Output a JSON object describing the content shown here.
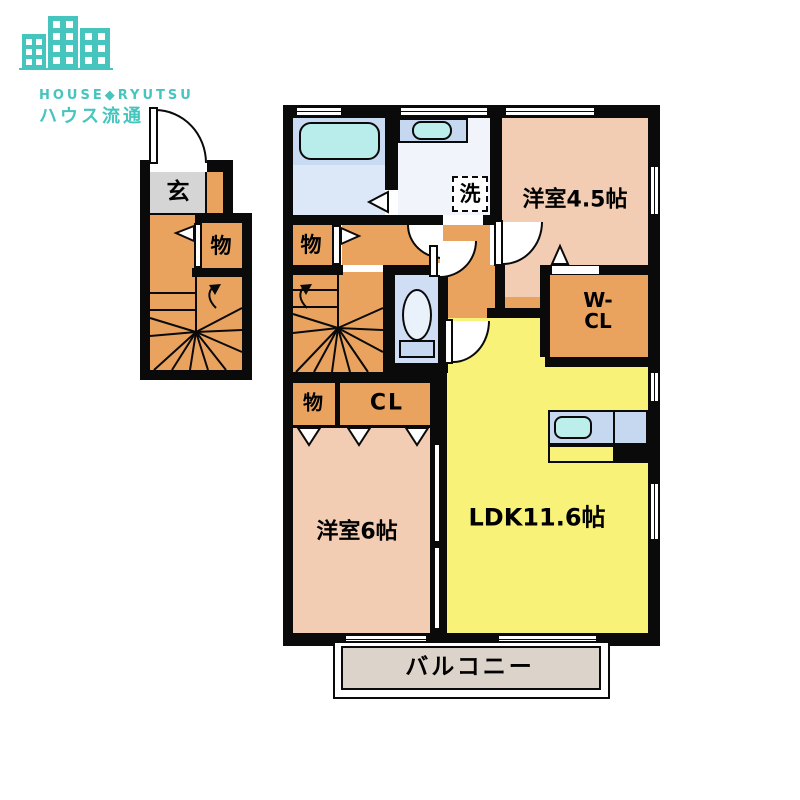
{
  "logo": {
    "brand_en": "HOUSE◆RYUTSU",
    "brand_jp": "ハウス流通",
    "color": "#45c5bd"
  },
  "first_floor": {
    "entrance": "玄",
    "storage": "物"
  },
  "second_floor": {
    "hall_storage": "物",
    "laundry": "洗",
    "bedroom1": "洋室4.5帖",
    "wic_line1": "W-",
    "wic_line2": "CL",
    "closet_storage": "物",
    "closet": "CL",
    "bedroom2": "洋室6帖",
    "ldk": "LDK11.6帖",
    "balcony": "バルコニー"
  },
  "colors": {
    "wall": "#0a0a0a",
    "wood_orange": "#e9a35f",
    "room_pink": "#f2cdb4",
    "ldk_yellow": "#f8f378",
    "genkan_gray": "#d5d5d5",
    "balcony_beige": "#dcd4cb",
    "bath_blue": "#c9dbf2",
    "tub_cyan": "#b9edec",
    "brand_teal": "#45c5bd"
  }
}
